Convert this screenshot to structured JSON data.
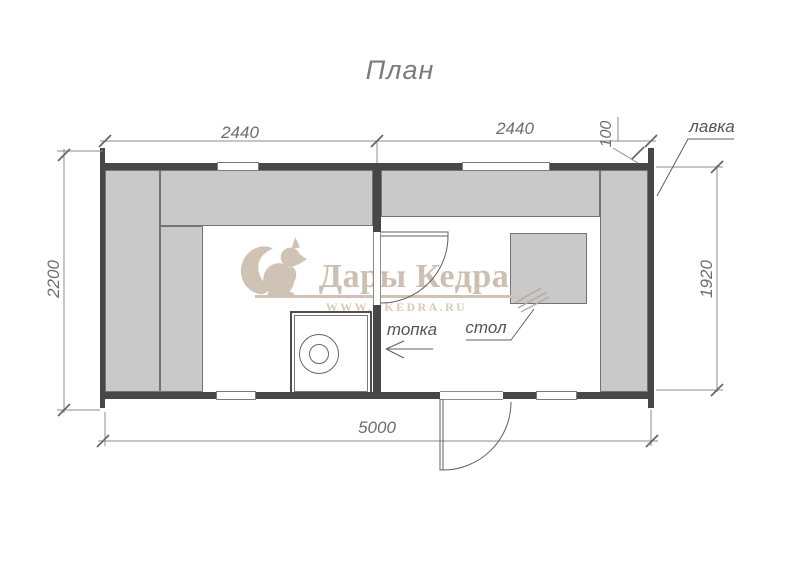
{
  "title": "План",
  "watermark": {
    "brand": "Дары Кедра",
    "url": "WWW.DKEDRA.RU",
    "logo_icon": "squirrel-icon"
  },
  "labels": {
    "bench": "лавка",
    "firebox": "топка",
    "table": "стол"
  },
  "dimensions": {
    "top_left_width": "2440",
    "top_right_width": "2440",
    "top_offset": "100",
    "left_depth": "2200",
    "right_inner_depth": "1920",
    "bottom_total_width": "5000"
  },
  "colors": {
    "wall": "#474747",
    "bench_fill": "#c9c9c9",
    "bench_border": "#747474",
    "dim_line": "#8b8b8b",
    "dim_text": "#6e6e6e",
    "watermark": "#cfc3b6"
  }
}
